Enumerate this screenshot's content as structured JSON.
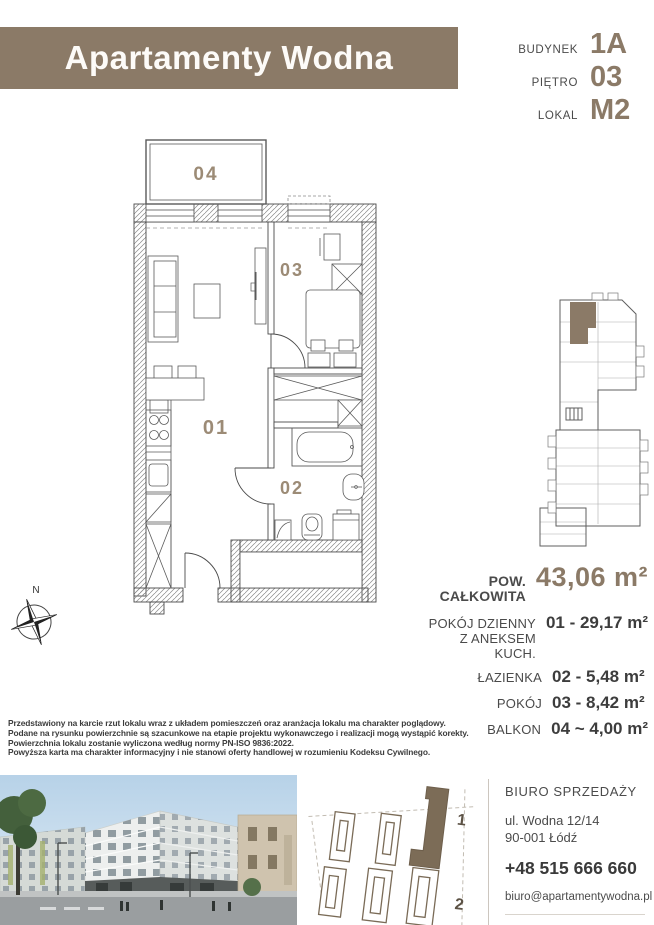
{
  "header": {
    "brand": "Apartamenty Wodna",
    "building_label": "BUDYNEK",
    "building_value": "1A",
    "floor_label": "PIĘTRO",
    "floor_value": "03",
    "unit_label": "LOKAL",
    "unit_value": "M2"
  },
  "plan": {
    "room_01": "01",
    "room_02": "02",
    "room_03": "03",
    "room_04": "04",
    "compass_n": "N"
  },
  "areas": {
    "total_label": "POW. CAŁKOWITA",
    "total_value": "43,06 m²",
    "rows": [
      {
        "label1": "POKÓJ DZIENNY",
        "label2": "Z ANEKSEM KUCH.",
        "value": "01 - 29,17 m²"
      },
      {
        "label1": "ŁAZIENKA",
        "label2": "",
        "value": "02 - 5,48 m²"
      },
      {
        "label1": "POKÓJ",
        "label2": "",
        "value": "03 - 8,42 m²"
      },
      {
        "label1": "BALKON",
        "label2": "",
        "value": "04 ~ 4,00 m²"
      }
    ]
  },
  "disclaimer": {
    "line1": "Przedstawiony na karcie rzut lokalu wraz z układem pomieszczeń oraz aranżacja lokalu ma charakter poglądowy.",
    "line2": "Podane na rysunku powierzchnie są szacunkowe na etapie projektu wykonawczego i realizacji mogą wystąpić korekty.",
    "line3": "Powierzchnia lokalu zostanie wyliczona według normy PN-ISO 9836:2022.",
    "line4": "Powyższa karta ma charakter informacyjny i nie stanowi oferty handlowej w rozumieniu Kodeksu Cywilnego."
  },
  "site_plan": {
    "building1_label": "1",
    "building2_label": "2"
  },
  "contact": {
    "office_label": "BIURO SPRZEDAŻY",
    "address_line1": "ul. Wodna 12/14",
    "address_line2": "90-001 Łódź",
    "phone": "+48 515 666 660",
    "email": "biuro@apartamentywodna.pl",
    "website": "apartamentywodna.pl"
  },
  "colors": {
    "brand_brown": "#8B7A67",
    "room_label_brown": "#9C8B76",
    "site_building_fill": "#7C6C57"
  }
}
